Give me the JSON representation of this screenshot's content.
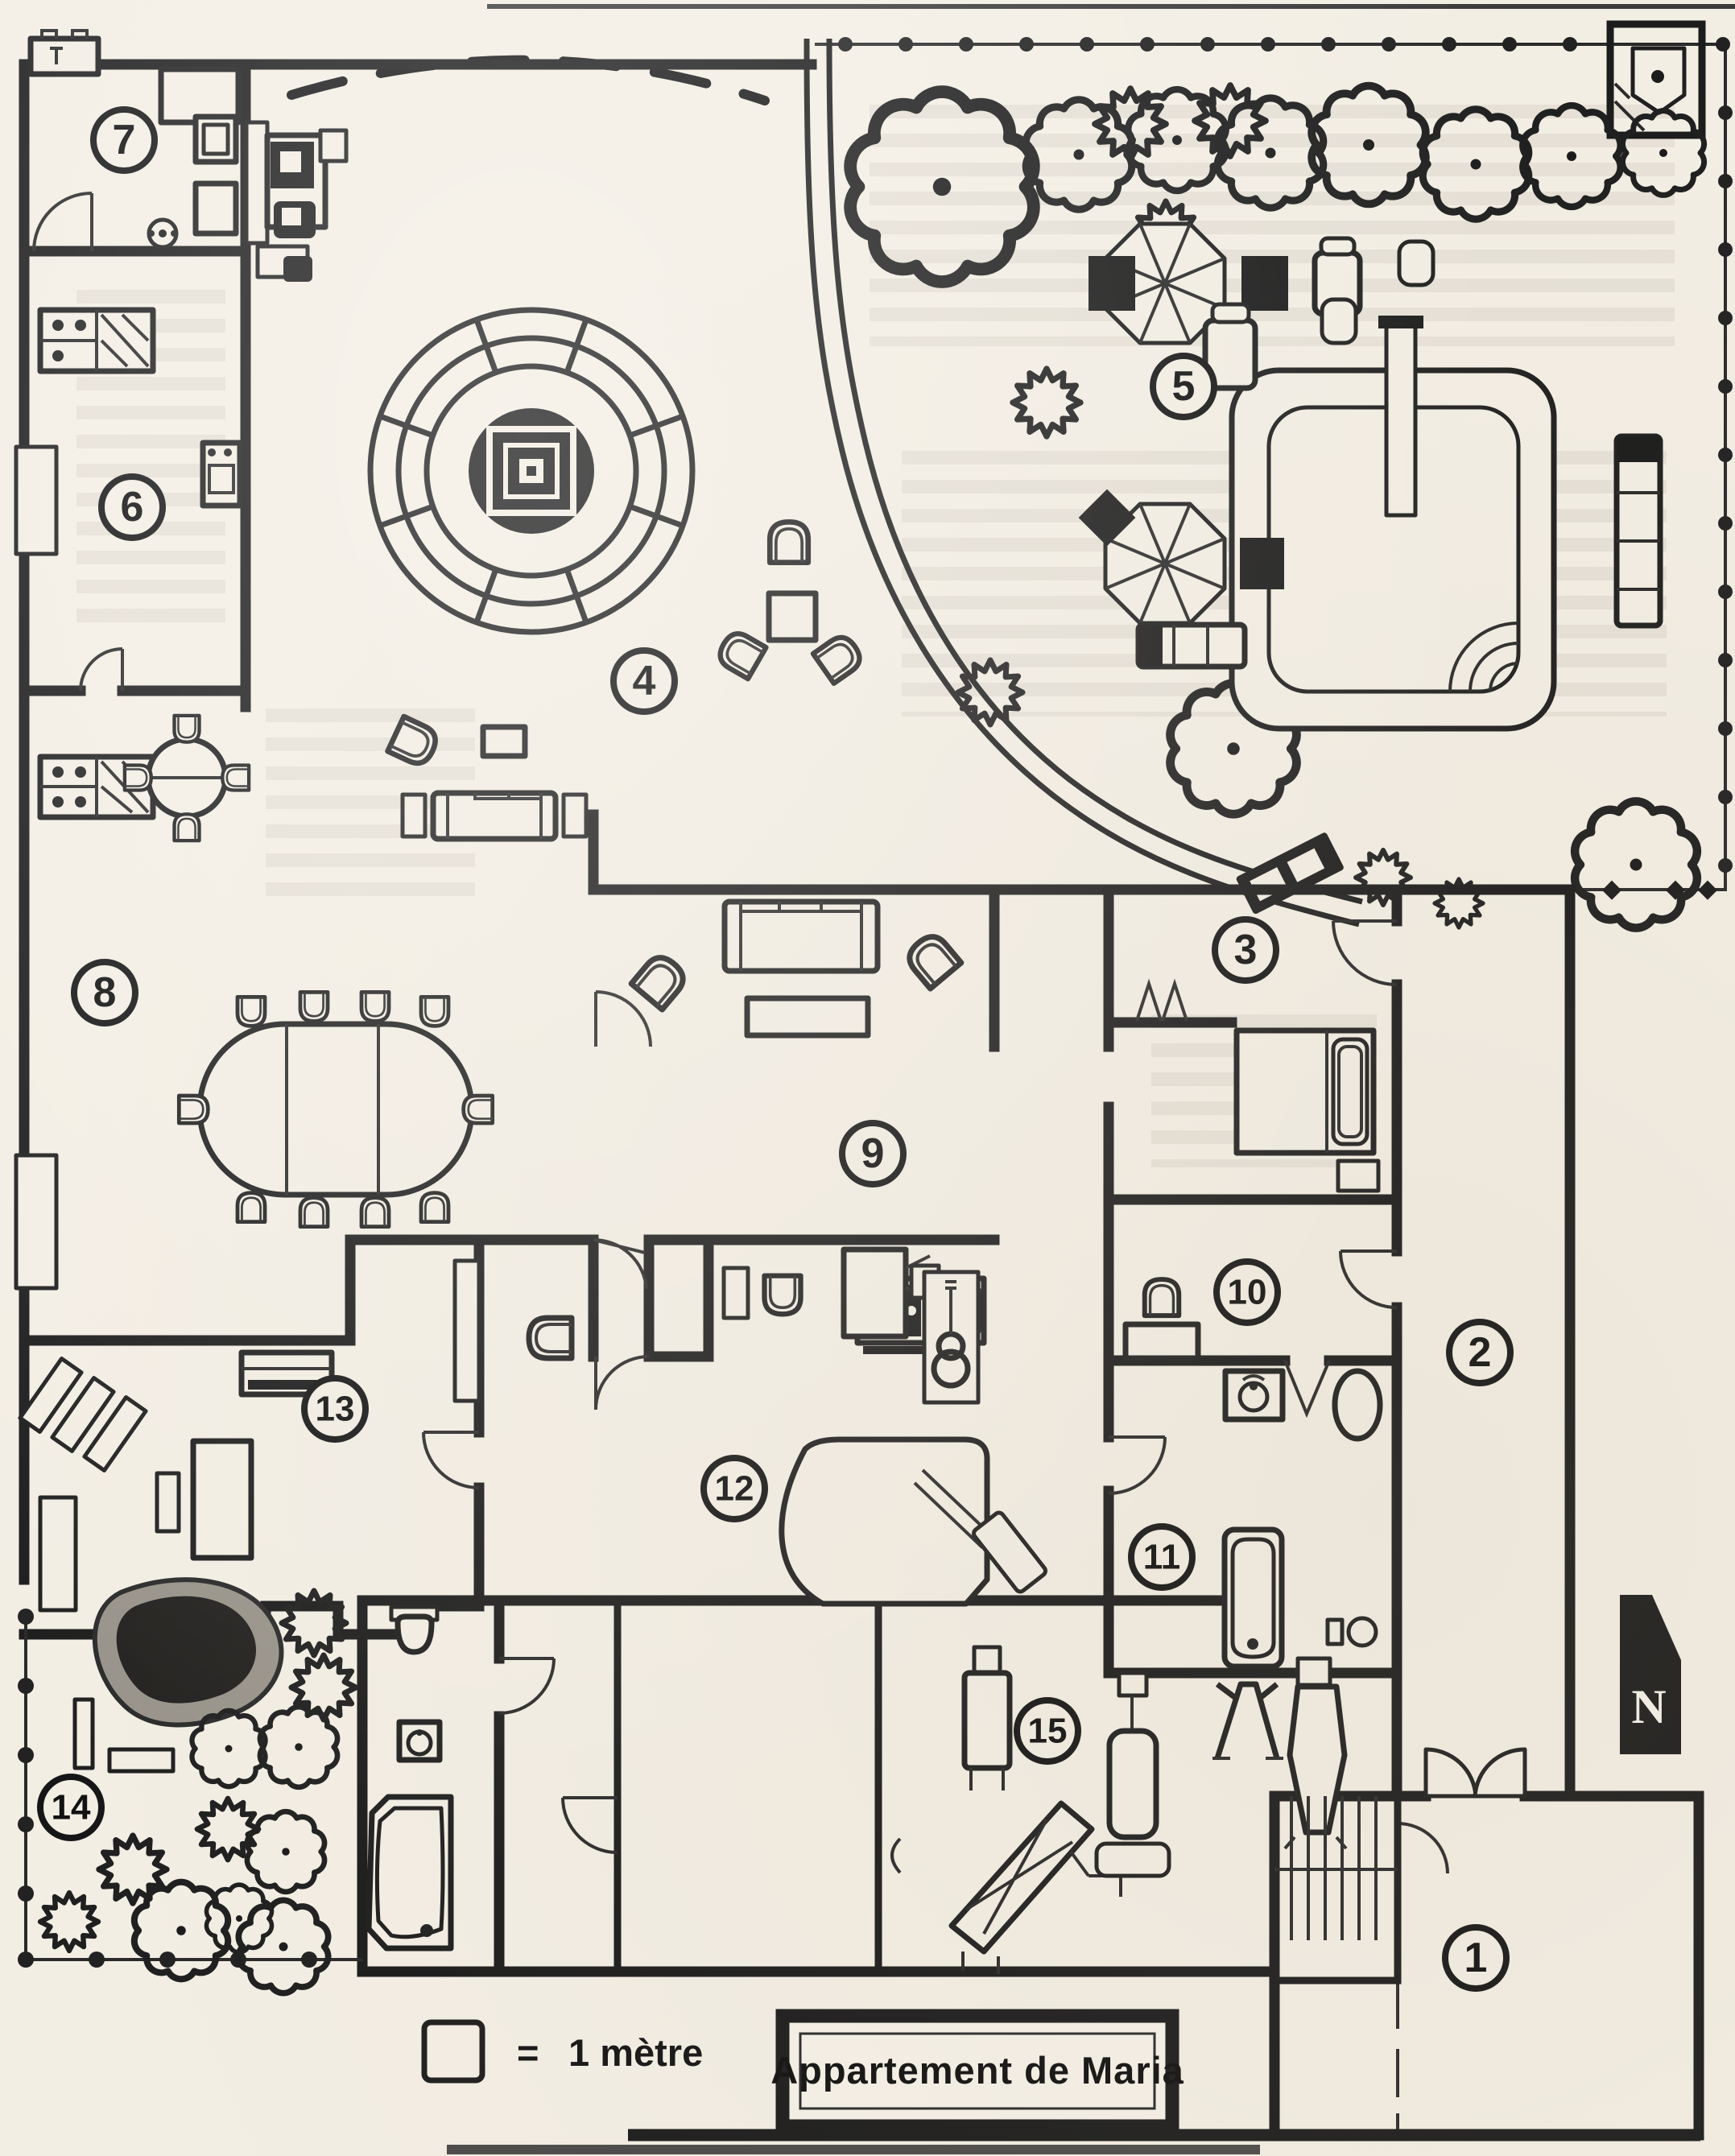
{
  "title_box": {
    "title": "Appartement de Maria"
  },
  "legend": {
    "equals_sign": "=",
    "scale_text": "1 mètre"
  },
  "compass": {
    "north_label": "N"
  },
  "rooms": [
    {
      "number": "1"
    },
    {
      "number": "2"
    },
    {
      "number": "3"
    },
    {
      "number": "4"
    },
    {
      "number": "5"
    },
    {
      "number": "6"
    },
    {
      "number": "7"
    },
    {
      "number": "8"
    },
    {
      "number": "9"
    },
    {
      "number": "10"
    },
    {
      "number": "11"
    },
    {
      "number": "12"
    },
    {
      "number": "13"
    },
    {
      "number": "14"
    },
    {
      "number": "15"
    }
  ]
}
